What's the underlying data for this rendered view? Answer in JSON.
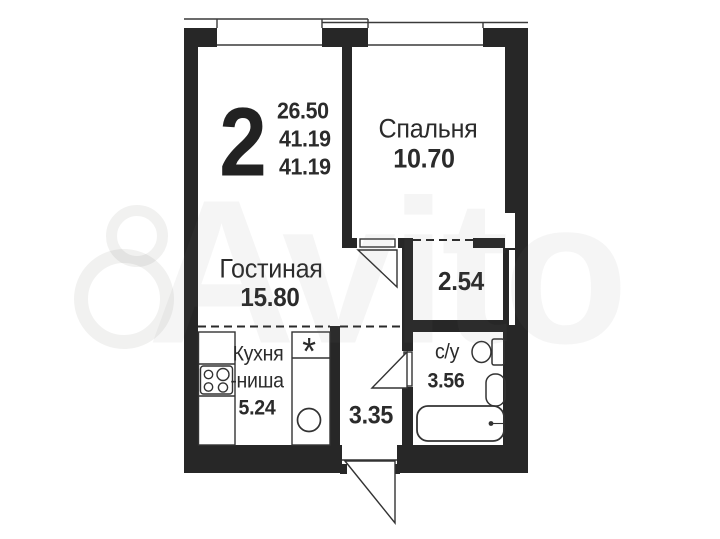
{
  "header": {
    "rooms_count": "2",
    "areas": [
      "26.50",
      "41.19",
      "41.19"
    ]
  },
  "rooms": {
    "bedroom": {
      "label": "Спальня",
      "area": "10.70"
    },
    "living_room": {
      "label": "Гостиная",
      "area": "15.80"
    },
    "kitchen": {
      "label_line1": "Кухня",
      "label_line2": "-ниша",
      "area": "5.24",
      "note_symbol": "*"
    },
    "wardrobe": {
      "area": "2.54"
    },
    "hallway": {
      "area": "3.35"
    },
    "bathroom": {
      "label": "с/у",
      "area": "3.56"
    }
  },
  "watermark": {
    "text": "Avito"
  },
  "colors": {
    "wall": "#272727",
    "line": "#333333",
    "background": "#ffffff"
  }
}
